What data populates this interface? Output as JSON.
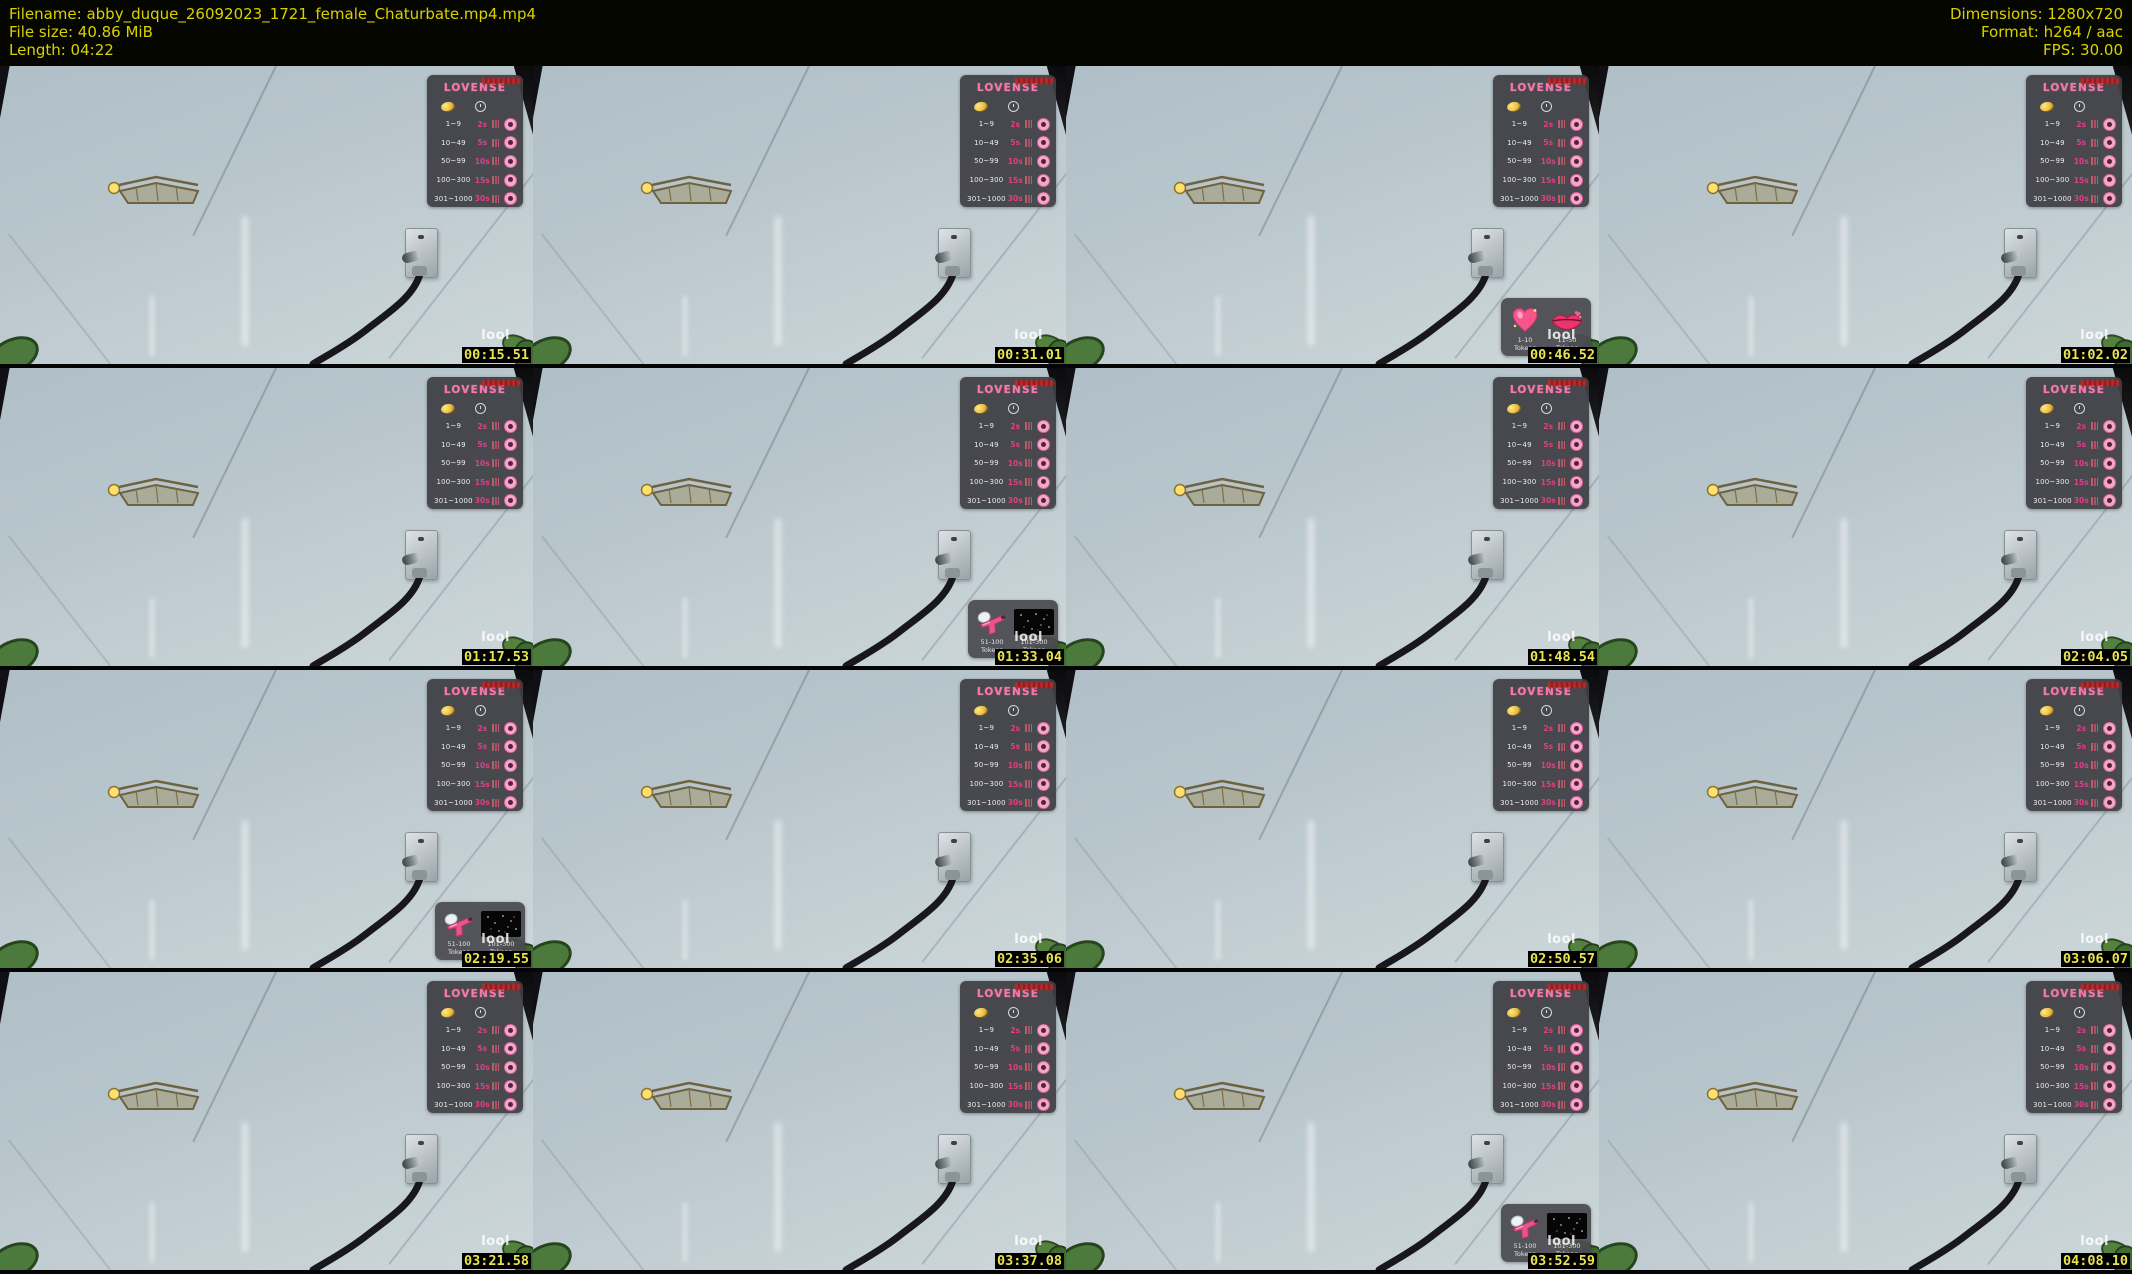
{
  "header": {
    "left_lines": [
      "Filename: abby_duque_26092023_1721_female_Chaturbate.mp4.mp4",
      "File size: 40.86 MiB",
      "Length: 04:22"
    ],
    "right_lines": [
      "Dimensions: 1280x720",
      "Format: h264 / aac",
      "FPS: 30.00"
    ]
  },
  "watermark": "lool",
  "lovense_panel": {
    "brand": "LOVENSE",
    "rows": [
      {
        "range": "1~9",
        "value": "2s"
      },
      {
        "range": "10~49",
        "value": "5s"
      },
      {
        "range": "50~99",
        "value": "10s"
      },
      {
        "range": "100~300",
        "value": "15s"
      },
      {
        "range": "301~1000",
        "value": "30s"
      }
    ]
  },
  "gift_overlays": {
    "hearts": [
      {
        "icon": "heart-icon",
        "label": "1-10 Tokens"
      },
      {
        "icon": "lips-icon",
        "label": "11-50 Tokens"
      }
    ],
    "pistol": [
      {
        "icon": "water-gun-icon",
        "label": "51-100 Tokens"
      },
      {
        "icon": "fireworks-icon",
        "label": "101-300 Tokens"
      }
    ]
  },
  "colors": {
    "header_text": "#d8d200",
    "timestamp_text": "#e9e44e",
    "timestamp_bg": "#000000",
    "accent_pink": "#f478a8",
    "wall": "#b8c6cc"
  },
  "tiles": [
    {
      "timestamp": "00:15.51",
      "overlay": "none"
    },
    {
      "timestamp": "00:31.01",
      "overlay": "none"
    },
    {
      "timestamp": "00:46.52",
      "overlay": "hearts"
    },
    {
      "timestamp": "01:02.02",
      "overlay": "none"
    },
    {
      "timestamp": "01:17.53",
      "overlay": "none"
    },
    {
      "timestamp": "01:33.04",
      "overlay": "pistol"
    },
    {
      "timestamp": "01:48.54",
      "overlay": "none"
    },
    {
      "timestamp": "02:04.05",
      "overlay": "none"
    },
    {
      "timestamp": "02:19.55",
      "overlay": "pistol"
    },
    {
      "timestamp": "02:35.06",
      "overlay": "none"
    },
    {
      "timestamp": "02:50.57",
      "overlay": "none"
    },
    {
      "timestamp": "03:06.07",
      "overlay": "none"
    },
    {
      "timestamp": "03:21.58",
      "overlay": "none"
    },
    {
      "timestamp": "03:37.08",
      "overlay": "none"
    },
    {
      "timestamp": "03:52.59",
      "overlay": "pistol"
    },
    {
      "timestamp": "04:08.10",
      "overlay": "none"
    }
  ]
}
